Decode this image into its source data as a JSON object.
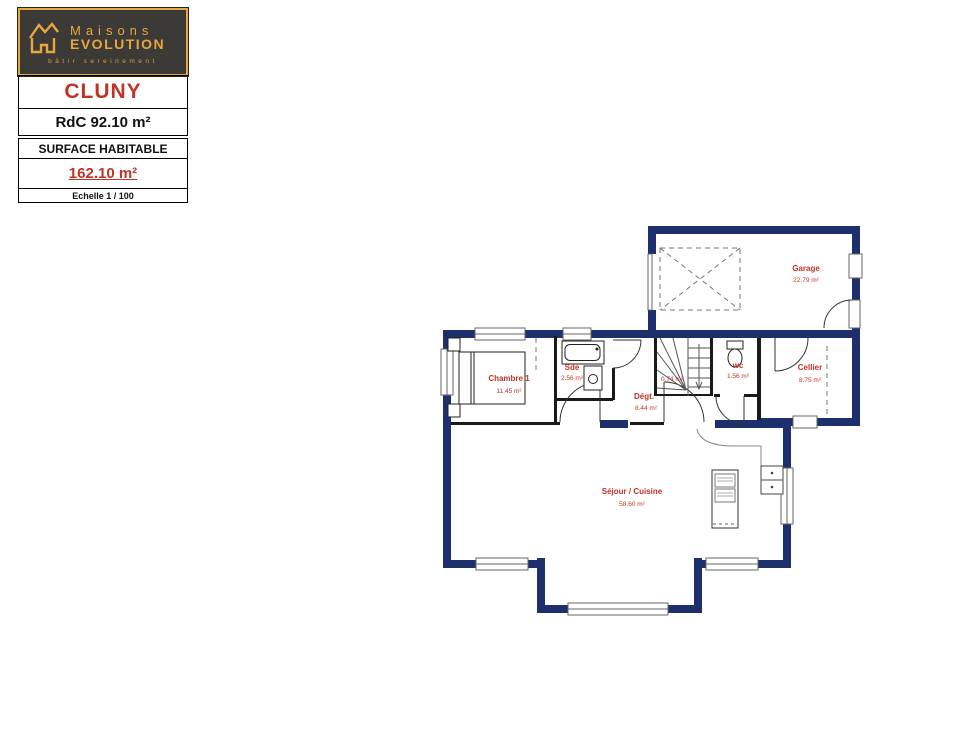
{
  "title_block": {
    "brand": {
      "line1": "Maisons",
      "line2": "EVOLUTION",
      "tagline": "bâtir sereinement"
    },
    "model_name": "CLUNY",
    "floor_label": "RdC 92.10 m²",
    "surface_title": "SURFACE HABITABLE",
    "surface_value": "162.10 m²",
    "scale": "Echelle 1 / 100"
  },
  "plan": {
    "rooms": {
      "garage": {
        "name": "Garage",
        "area": "22.79 m²"
      },
      "chambre1": {
        "name": "Chambre 1",
        "area": "11.45 m²"
      },
      "sde": {
        "name": "Sde",
        "area": "2.56 m²"
      },
      "degagement": {
        "name": "Dégt.",
        "area": "8.44 m²"
      },
      "wc": {
        "name": "wc",
        "area": "1.56 m²"
      },
      "cellier": {
        "name": "Cellier",
        "area": "8.75 m²"
      },
      "sejour": {
        "name": "Séjour / Cuisine",
        "area": "58.60 m²"
      },
      "escalier": {
        "area": "0.74 m²"
      }
    }
  },
  "colors": {
    "wall_navy": "#1e2f6e",
    "label_red": "#c13327",
    "brand_gold": "#e8a63e",
    "logo_background": "#3c3a37"
  }
}
